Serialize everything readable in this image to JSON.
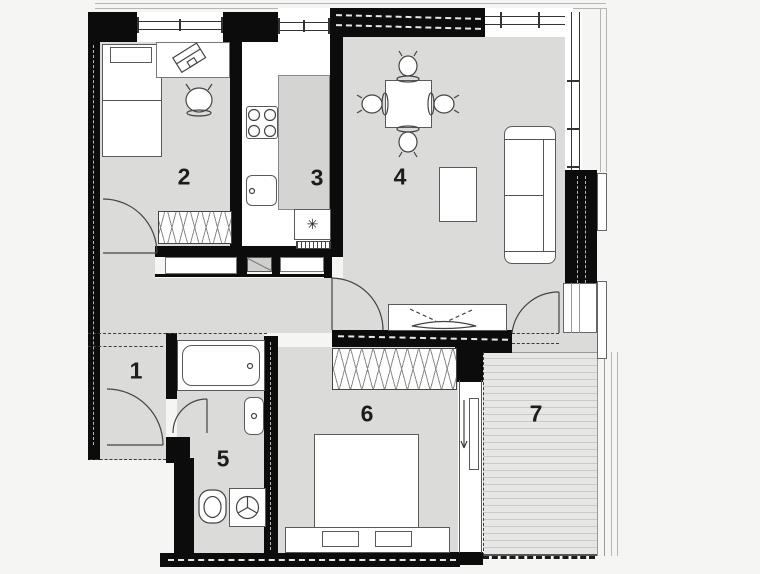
{
  "plan": {
    "rooms": [
      {
        "id": "1",
        "label": "1"
      },
      {
        "id": "2",
        "label": "2"
      },
      {
        "id": "3",
        "label": "3"
      },
      {
        "id": "4",
        "label": "4"
      },
      {
        "id": "5",
        "label": "5"
      },
      {
        "id": "6",
        "label": "6"
      },
      {
        "id": "7",
        "label": "7"
      }
    ],
    "symbols": {
      "fridge_star": "✳"
    },
    "colors": {
      "wall": "#0c0c0c",
      "floor": "#dbdbd9",
      "counter": "#ffffff",
      "deck": "#e6e6e4",
      "background": "#f5f5f3",
      "line": "#555555"
    }
  }
}
